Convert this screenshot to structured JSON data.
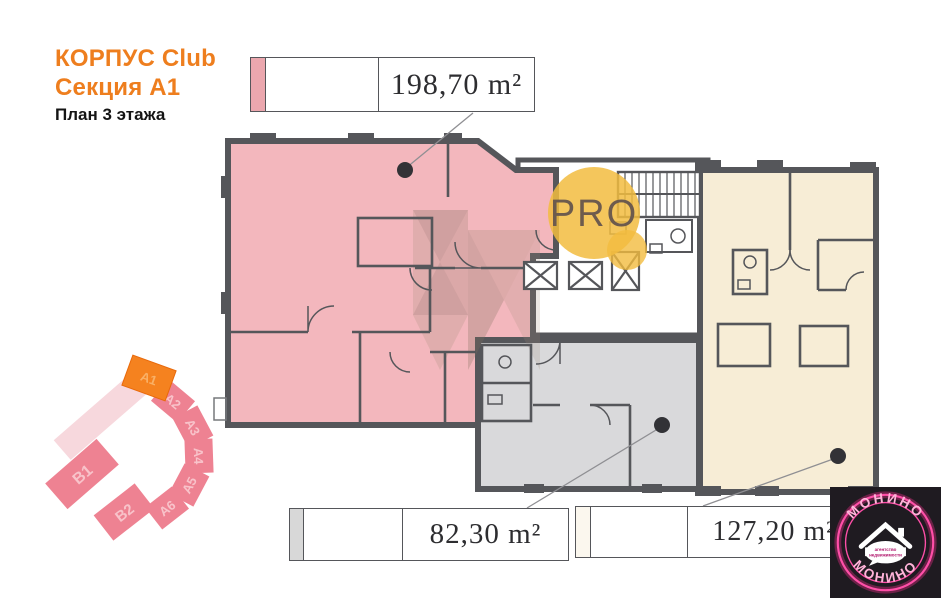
{
  "header": {
    "building": "КОРПУС Club",
    "section": "Секция А1",
    "floor_plan": "План 3 этажа",
    "accent_color": "#ee7e1e"
  },
  "areas": [
    {
      "name": "apartment-pink",
      "label": "198,70 m²",
      "fill": "#f3b7bd",
      "swatch": "#eba7ae"
    },
    {
      "name": "apartment-gray",
      "label": "82,30 m²",
      "fill": "#d9d9db",
      "swatch": "#d8d8d8"
    },
    {
      "name": "apartment-beige",
      "label": "127,20 m²",
      "fill": "#f7edd6",
      "swatch": "#fbf7ee"
    }
  ],
  "minimap": {
    "highlight_color": "#f5821f",
    "section_color": "#ee8292",
    "faded_color": "#f7d8dd",
    "sections": [
      {
        "label": "A1",
        "highlighted": true
      },
      {
        "label": "A2",
        "highlighted": false
      },
      {
        "label": "A3",
        "highlighted": false
      },
      {
        "label": "A4",
        "highlighted": false
      },
      {
        "label": "A5",
        "highlighted": false
      },
      {
        "label": "A6",
        "highlighted": false
      },
      {
        "label": "B2",
        "highlighted": false
      },
      {
        "label": "B1",
        "highlighted": false
      }
    ]
  },
  "watermark": {
    "text": "PRO",
    "circle_color": "#f2bc3f"
  },
  "logo": {
    "name": "МОНИНО",
    "name_bottom": "МОНИНО",
    "tagline_line1": "агентство",
    "tagline_line2": "недвижимости",
    "accent": "#ff2f92"
  },
  "colors": {
    "wall": "#55565a",
    "apartment_pink": "#f3b7bd",
    "apartment_gray": "#d9d9db",
    "apartment_beige": "#f7edd6",
    "leader_line": "#8f8f93",
    "leader_dot": "#323236"
  }
}
